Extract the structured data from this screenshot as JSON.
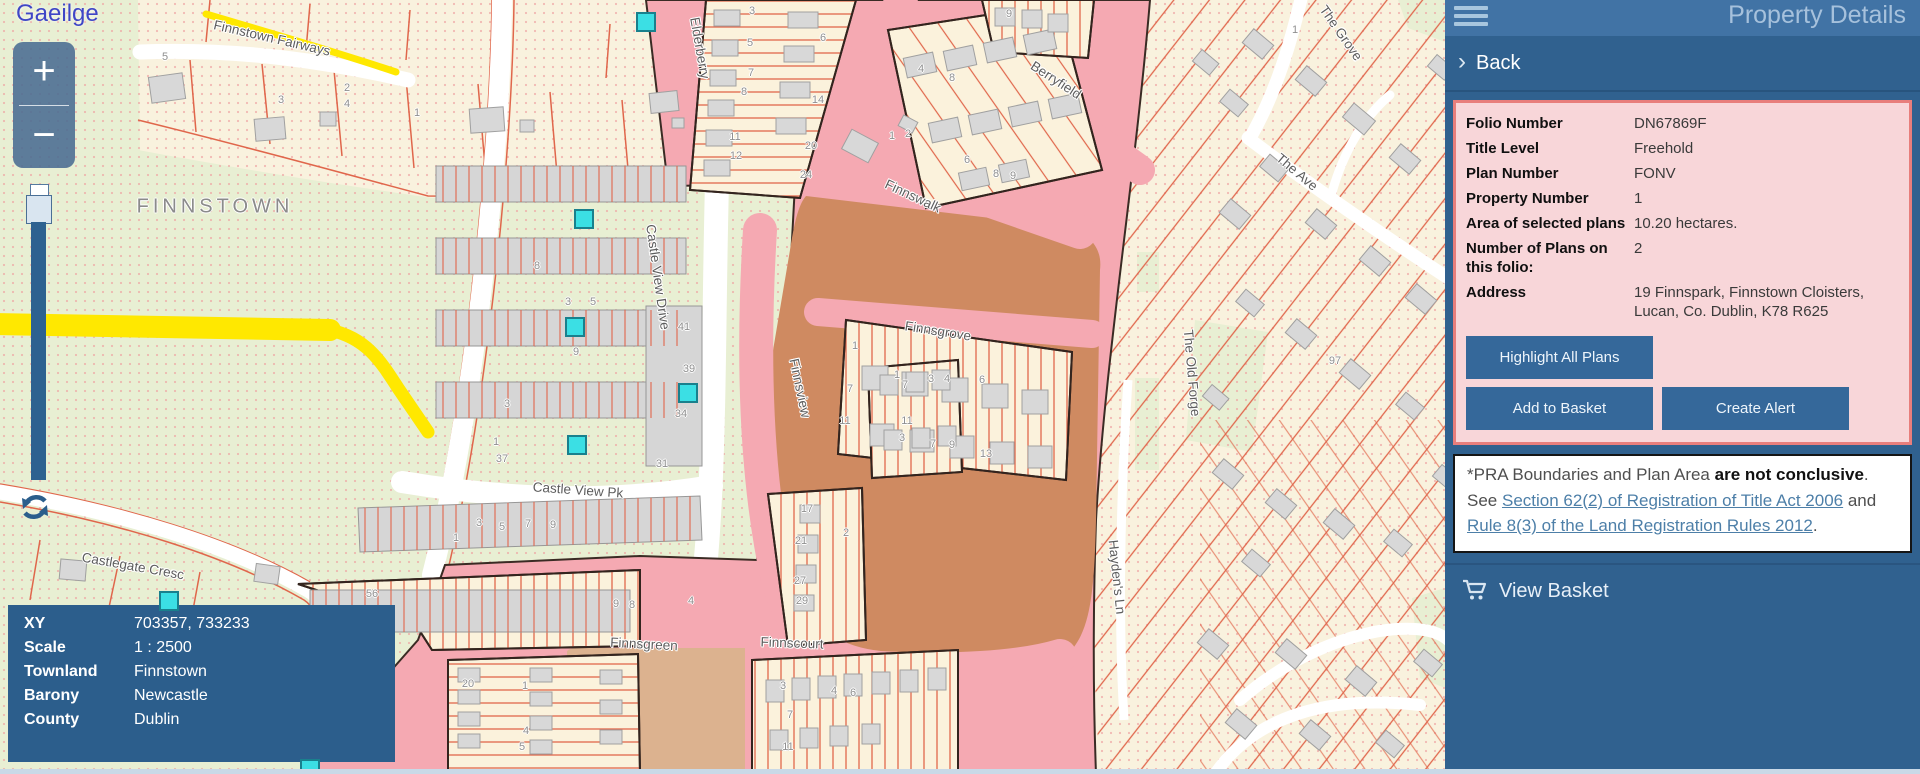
{
  "map": {
    "language_link": "Gaeilge",
    "zoom_in_label": "+",
    "zoom_out_label": "−",
    "region_label": "FINNSTOWN",
    "street_labels": [
      {
        "text": "Finnstown Fairways",
        "x": 272,
        "y": 38,
        "r": 13
      },
      {
        "text": "Elderberry",
        "x": 700,
        "y": 48,
        "r": 80
      },
      {
        "text": "Berryfield",
        "x": 1056,
        "y": 80,
        "r": 33
      },
      {
        "text": "Finnswalk",
        "x": 913,
        "y": 196,
        "r": 25
      },
      {
        "text": "Finnsgrove",
        "x": 938,
        "y": 331,
        "r": 9
      },
      {
        "text": "Finnsview",
        "x": 800,
        "y": 388,
        "r": 78
      },
      {
        "text": "Castle View Drive",
        "x": 658,
        "y": 277,
        "r": 82
      },
      {
        "text": "Castle View Pk",
        "x": 578,
        "y": 490,
        "r": 4
      },
      {
        "text": "Finnsgreen",
        "x": 644,
        "y": 644,
        "r": 3
      },
      {
        "text": "Finnscourt",
        "x": 792,
        "y": 643,
        "r": 2
      },
      {
        "text": "The Grove",
        "x": 1341,
        "y": 33,
        "r": 55
      },
      {
        "text": "The Ave",
        "x": 1297,
        "y": 172,
        "r": 40
      },
      {
        "text": "The Old Forge",
        "x": 1192,
        "y": 373,
        "r": 85
      },
      {
        "text": "Hayden's Ln",
        "x": 1117,
        "y": 577,
        "r": 84
      },
      {
        "text": "Castlegate Cresc",
        "x": 133,
        "y": 566,
        "r": 10
      }
    ],
    "lot_numbers": [
      {
        "t": "5",
        "x": 165,
        "y": 57
      },
      {
        "t": "3",
        "x": 281,
        "y": 100
      },
      {
        "t": "2",
        "x": 347,
        "y": 88
      },
      {
        "t": "4",
        "x": 347,
        "y": 104
      },
      {
        "t": "1",
        "x": 417,
        "y": 113
      },
      {
        "t": "9",
        "x": 1009,
        "y": 14
      },
      {
        "t": "6",
        "x": 823,
        "y": 38
      },
      {
        "t": "4",
        "x": 921,
        "y": 69
      },
      {
        "t": "8",
        "x": 952,
        "y": 78
      },
      {
        "t": "3",
        "x": 752,
        "y": 11
      },
      {
        "t": "5",
        "x": 750,
        "y": 43
      },
      {
        "t": "7",
        "x": 751,
        "y": 73
      },
      {
        "t": "8",
        "x": 744,
        "y": 92
      },
      {
        "t": "14",
        "x": 818,
        "y": 100
      },
      {
        "t": "11",
        "x": 735,
        "y": 137
      },
      {
        "t": "12",
        "x": 736,
        "y": 156
      },
      {
        "t": "20",
        "x": 811,
        "y": 146
      },
      {
        "t": "24",
        "x": 806,
        "y": 175
      },
      {
        "t": "1",
        "x": 892,
        "y": 136
      },
      {
        "t": "2",
        "x": 908,
        "y": 134
      },
      {
        "t": "6",
        "x": 967,
        "y": 160
      },
      {
        "t": "8",
        "x": 996,
        "y": 174
      },
      {
        "t": "9",
        "x": 1013,
        "y": 176
      },
      {
        "t": "1",
        "x": 1295,
        "y": 30
      },
      {
        "t": "8",
        "x": 537,
        "y": 266
      },
      {
        "t": "3",
        "x": 568,
        "y": 302
      },
      {
        "t": "5",
        "x": 593,
        "y": 302
      },
      {
        "t": "9",
        "x": 576,
        "y": 352
      },
      {
        "t": "41",
        "x": 684,
        "y": 327
      },
      {
        "t": "39",
        "x": 689,
        "y": 369
      },
      {
        "t": "34",
        "x": 681,
        "y": 414
      },
      {
        "t": "31",
        "x": 662,
        "y": 464
      },
      {
        "t": "1",
        "x": 855,
        "y": 346
      },
      {
        "t": "7",
        "x": 850,
        "y": 389
      },
      {
        "t": "11",
        "x": 845,
        "y": 421
      },
      {
        "t": "1",
        "x": 897,
        "y": 375
      },
      {
        "t": "3",
        "x": 931,
        "y": 379
      },
      {
        "t": "4",
        "x": 947,
        "y": 379
      },
      {
        "t": "6",
        "x": 982,
        "y": 380
      },
      {
        "t": "3",
        "x": 902,
        "y": 438
      },
      {
        "t": "7",
        "x": 933,
        "y": 444
      },
      {
        "t": "9",
        "x": 952,
        "y": 445
      },
      {
        "t": "13",
        "x": 986,
        "y": 454
      },
      {
        "t": "7",
        "x": 905,
        "y": 385
      },
      {
        "t": "11",
        "x": 907,
        "y": 421
      },
      {
        "t": "3",
        "x": 507,
        "y": 404
      },
      {
        "t": "1",
        "x": 496,
        "y": 442
      },
      {
        "t": "37",
        "x": 502,
        "y": 459
      },
      {
        "t": "1",
        "x": 456,
        "y": 538
      },
      {
        "t": "3",
        "x": 479,
        "y": 523
      },
      {
        "t": "5",
        "x": 502,
        "y": 527
      },
      {
        "t": "7",
        "x": 528,
        "y": 524
      },
      {
        "t": "9",
        "x": 553,
        "y": 525
      },
      {
        "t": "9",
        "x": 616,
        "y": 604
      },
      {
        "t": "8",
        "x": 632,
        "y": 605
      },
      {
        "t": "4",
        "x": 691,
        "y": 601
      },
      {
        "t": "56",
        "x": 372,
        "y": 594
      },
      {
        "t": "17",
        "x": 807,
        "y": 509
      },
      {
        "t": "21",
        "x": 801,
        "y": 541
      },
      {
        "t": "27",
        "x": 800,
        "y": 581
      },
      {
        "t": "29",
        "x": 802,
        "y": 601
      },
      {
        "t": "20",
        "x": 468,
        "y": 684
      },
      {
        "t": "1",
        "x": 525,
        "y": 686
      },
      {
        "t": "4",
        "x": 526,
        "y": 731
      },
      {
        "t": "5",
        "x": 522,
        "y": 747
      },
      {
        "t": "3",
        "x": 783,
        "y": 686
      },
      {
        "t": "7",
        "x": 790,
        "y": 715
      },
      {
        "t": "11",
        "x": 788,
        "y": 747
      },
      {
        "t": "4",
        "x": 834,
        "y": 691
      },
      {
        "t": "6",
        "x": 853,
        "y": 693
      },
      {
        "t": "97",
        "x": 1335,
        "y": 361
      },
      {
        "t": "2",
        "x": 846,
        "y": 533
      }
    ],
    "markers": [
      {
        "x": 646,
        "y": 22
      },
      {
        "x": 584,
        "y": 219
      },
      {
        "x": 575,
        "y": 327
      },
      {
        "x": 688,
        "y": 393
      },
      {
        "x": 577,
        "y": 445
      },
      {
        "x": 169,
        "y": 601
      },
      {
        "x": 310,
        "y": 769
      }
    ],
    "info_rows": [
      {
        "label": "XY",
        "value": "703357, 733233"
      },
      {
        "label": "Scale",
        "value": "1 : 2500"
      },
      {
        "label": "Townland",
        "value": "Finnstown"
      },
      {
        "label": "Barony",
        "value": "Newcastle"
      },
      {
        "label": "County",
        "value": "Dublin"
      }
    ]
  },
  "panel": {
    "title": "Property Details",
    "back_label": "Back",
    "back_chevron": "›",
    "details_rows": [
      {
        "label": "Folio Number",
        "value": "DN67869F"
      },
      {
        "label": "Title Level",
        "value": "Freehold"
      },
      {
        "label": "Plan Number",
        "value": "FONV"
      },
      {
        "label": "Property Number",
        "value": "1"
      },
      {
        "label": "Area of selected plans",
        "value": "10.20 hectares."
      },
      {
        "label": "Number of Plans on this folio:",
        "value": "2"
      },
      {
        "label": "Address",
        "value": "19 Finnspark, Finnstown Cloisters, Lucan, Co. Dublin, K78 R625"
      }
    ],
    "buttons": {
      "highlight": "Highlight All Plans",
      "add_basket": "Add to Basket",
      "create_alert": "Create Alert"
    },
    "disclaimer": {
      "prefix": "*PRA Boundaries and Plan Area ",
      "bold": "are not conclusive",
      "mid": ". See ",
      "link1": "Section 62(2) of Registration of Title Act 2006",
      "and_text": " and ",
      "link2": "Rule 8(3) of the Land Registration Rules 2012",
      "suffix": "."
    },
    "view_basket_label": "View Basket"
  },
  "colors": {
    "panel_body_blue": "#30618f",
    "panel_header_blue": "#4173a5",
    "button_blue": "#35689a",
    "folio_box_pink": "#f8d6d9",
    "folio_box_border": "#e87e7c",
    "highlight_pink": "#f5a9b2",
    "selected_plan_orange": "#cf8a61",
    "selected_plan_tan": "#dcb28f",
    "marker_cyan": "#3bdfe4",
    "road_yellow": "#ffe800",
    "parcel_line_orange": "#e0664b",
    "link_blue": "#4d7fa8"
  }
}
